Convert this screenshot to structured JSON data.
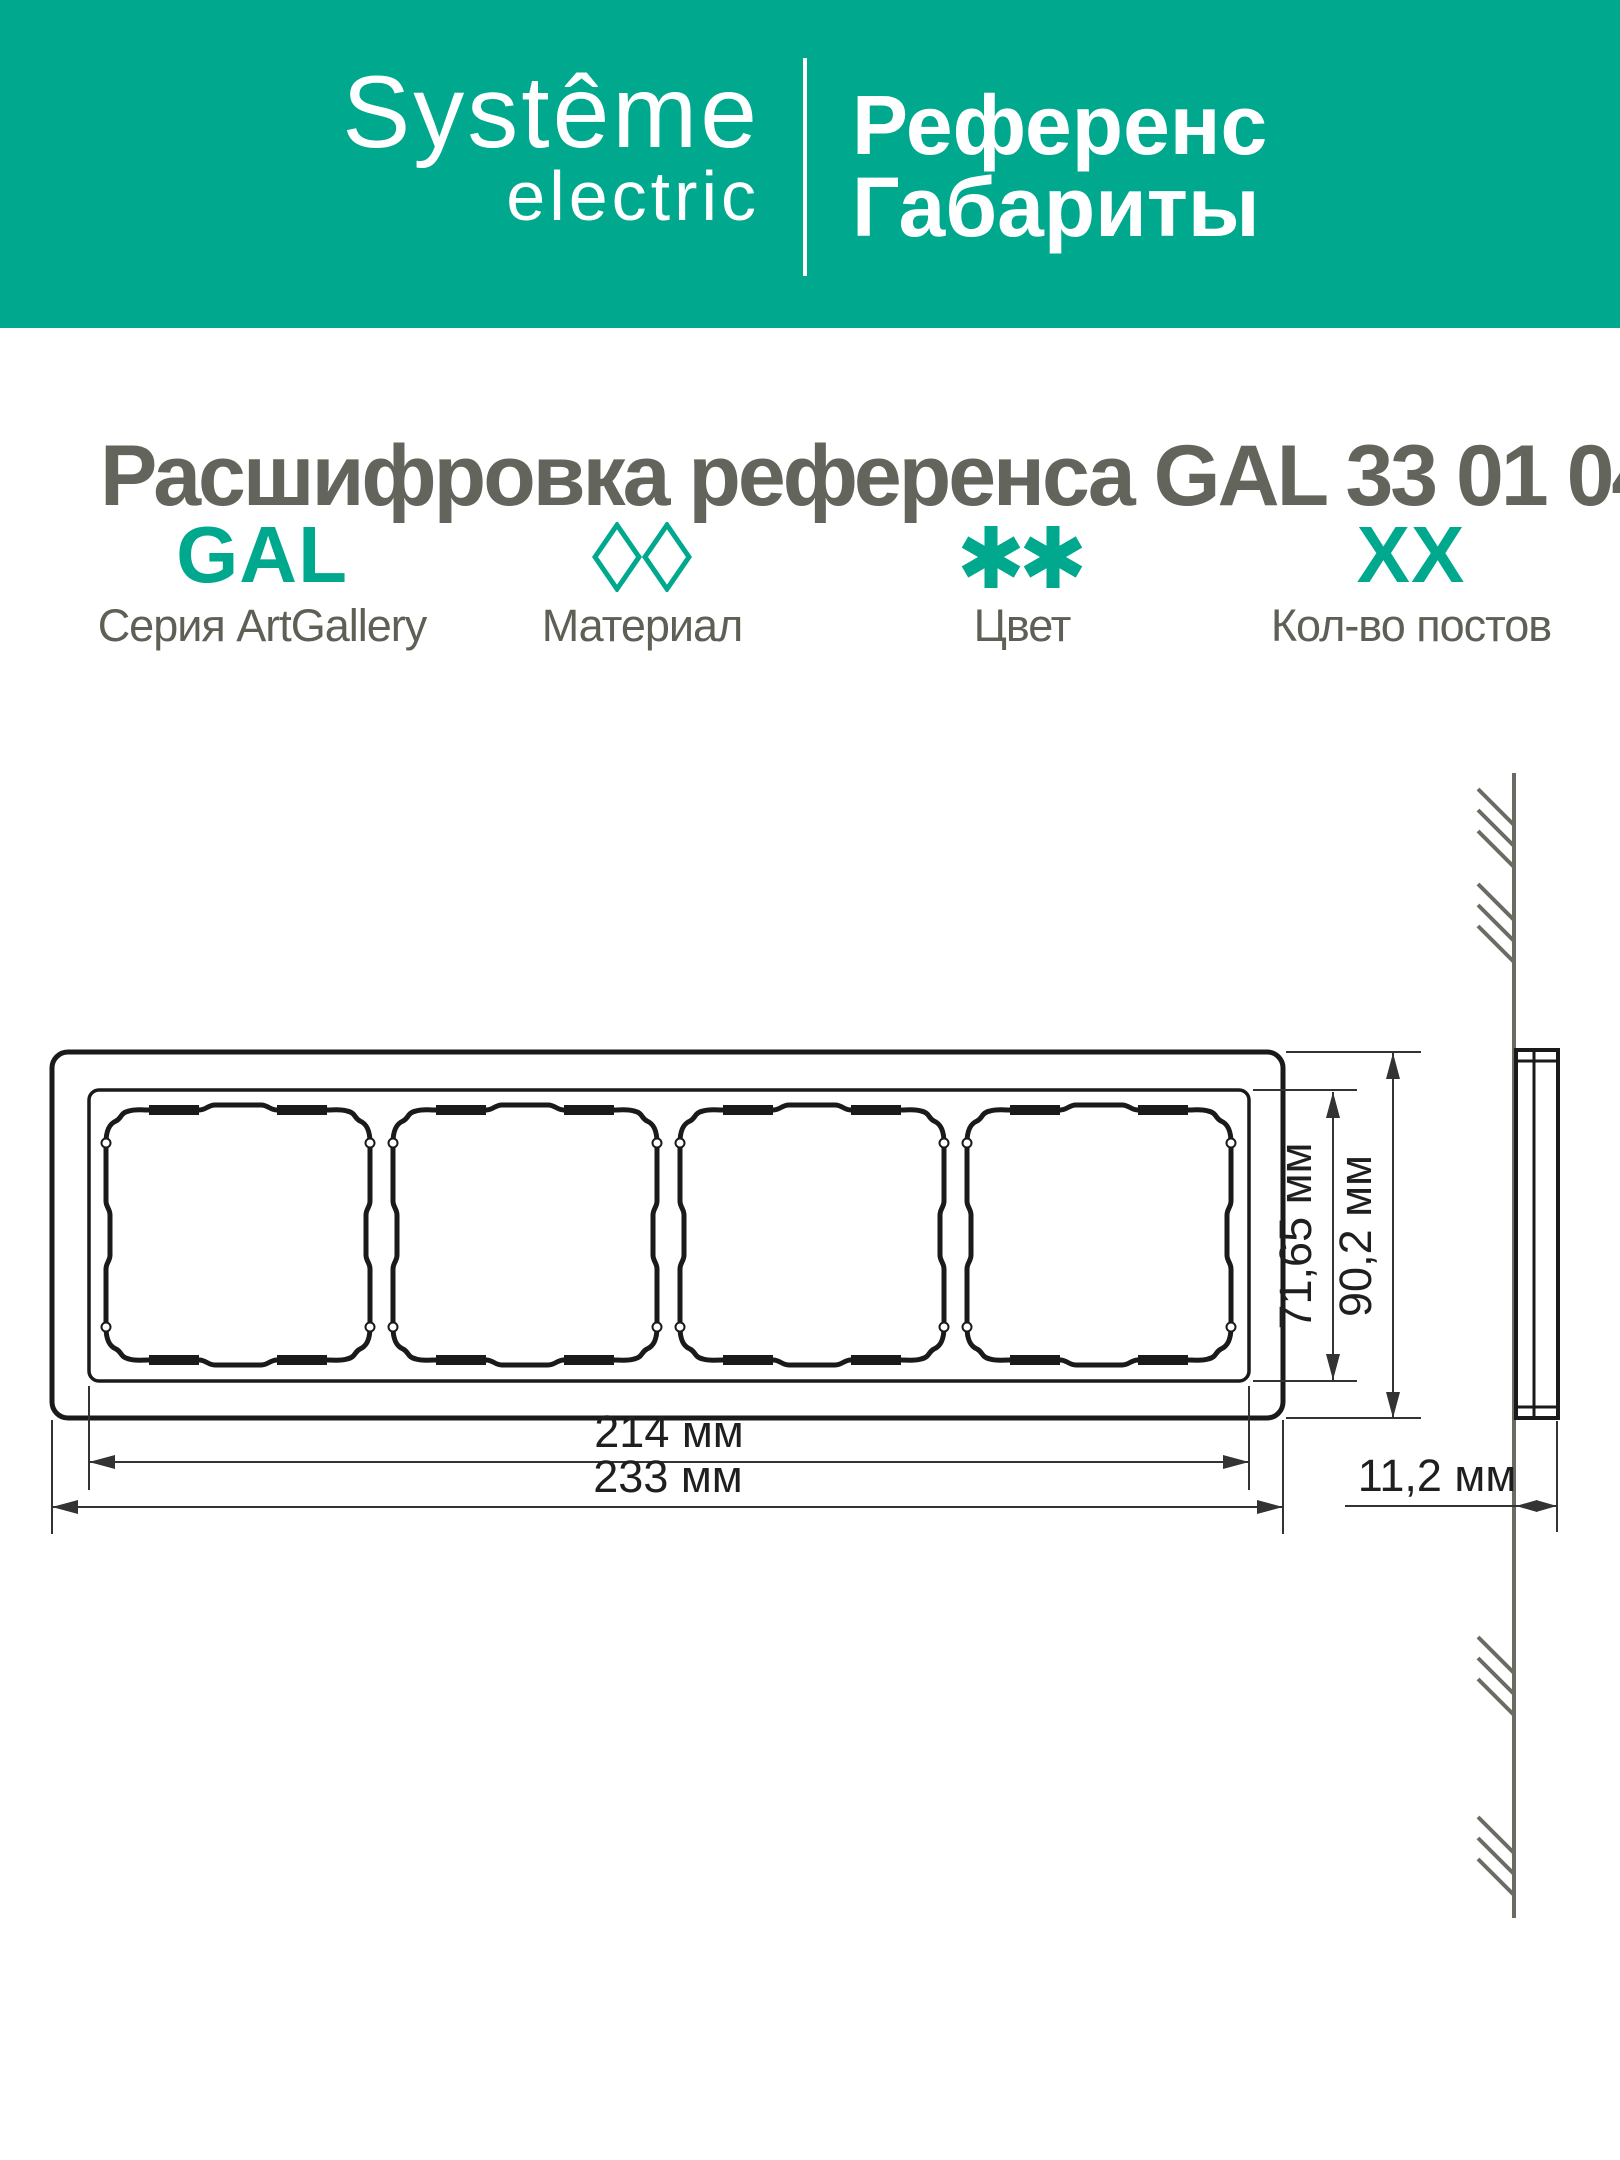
{
  "colors": {
    "accent": "#00A88E",
    "heading_text": "#63655C",
    "label_text": "#5E6056",
    "line": "#1A1A1A",
    "dim": "#333333",
    "wall": "#6B6B63"
  },
  "banner": {
    "brand_line1": "Systême",
    "brand_line2": "electric",
    "title_line1": "Референс",
    "title_line2": "Габариты"
  },
  "heading": {
    "text": "Расшифровка референса GAL 33 01 04"
  },
  "legend": {
    "columns": [
      {
        "code": "GAL",
        "symbol": "text",
        "label": "Серия ArtGallery"
      },
      {
        "code": "",
        "symbol": "diamonds",
        "label": "Материал"
      },
      {
        "code": "",
        "symbol": "asterisks",
        "label": "Цвет"
      },
      {
        "code": "XX",
        "symbol": "text",
        "label": "Кол-во постов"
      }
    ]
  },
  "drawing": {
    "type": "dimensioned technical drawing, 4-post frame, front and side view",
    "posts": 4,
    "dim_width_inner": "214 мм",
    "dim_width_outer": "233 мм",
    "dim_height_inner": "71,65 мм",
    "dim_height_outer": "90,2 мм",
    "dim_depth": "11,2 мм"
  }
}
